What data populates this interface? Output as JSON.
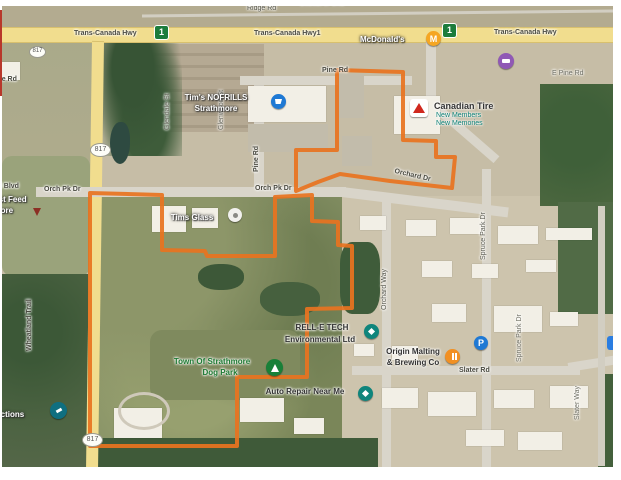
{
  "accent": {
    "boundary_orange": "#e8731f",
    "highway_yellow": "#f1dd8e",
    "poi_blue": "#1f79d4",
    "poi_teal": "#0f857c",
    "poi_green": "#188038",
    "poi_orange": "#f29022",
    "poi_purple": "#9059b5",
    "canadian_tire_red": "#d0281e"
  },
  "shields": {
    "trans_canada": "1",
    "hwy_817": "817"
  },
  "road_labels": {
    "ridge_rd": "Ridge Rd",
    "tch_left": "Trans-Canada Hwy",
    "tch_mid": "Trans-Canada Hwy1",
    "tch_right": "Trans-Canada Hwy",
    "e_pine_rd": "E Pine Rd",
    "pine_rd_top": "Pine Rd",
    "pine_rd_vertical": "Pine Rd",
    "glendale_st": "Glendale St",
    "glenwood_st": "Glenwood St",
    "re_rd": "re Rd",
    "al_blvd": "al Blvd",
    "orch_pk_dr_west": "Orch Pk Dr",
    "orch_pk_dr_mid": "Orch Pk Dr",
    "orchard_dr": "Orchard Dr",
    "spruce_park_dr": "Spruce Park Dr",
    "spruce_park_dr_south": "Spruce Park Dr",
    "orchard_way": "Orchard Way",
    "wheatland_trail": "Wheatland Trail",
    "slater_rd": "Slater Rd",
    "slater_way": "Slater Way"
  },
  "places": {
    "bobcat": "Bobcat of Sha",
    "mcdonalds": "McDonald's",
    "canadian_tire": "Canadian Tire",
    "canadian_tire_sub1": "New Members",
    "canadian_tire_sub2": "New Memories",
    "nofrills_line1": "Tim's NOFRILLS",
    "nofrills_line2": "Strathmore",
    "tims_glass": "Tims Glass",
    "just_feed_line1": "r Just Feed",
    "just_feed_line2": "thmore",
    "rell_e_tech_line1": "RELL-E TECH",
    "rell_e_tech_line2": "Environmental Ltd",
    "dog_park_line1": "Town Of Strathmore",
    "dog_park_line2": "Dog Park",
    "origin_line1": "Origin Malting",
    "origin_line2": "& Brewing Co",
    "auto_repair": "Auto Repair Near Me",
    "auctions": "Auctions",
    "parking": "P"
  }
}
